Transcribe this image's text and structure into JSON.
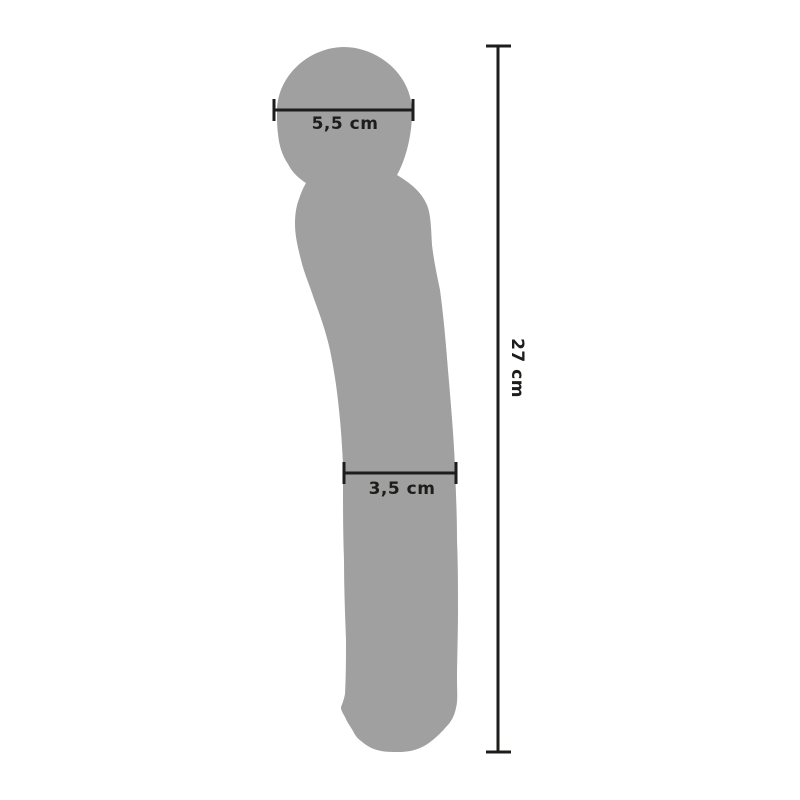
{
  "diagram": {
    "type": "product-dimension-drawing",
    "measurements": {
      "head_width": "5,5 cm",
      "shaft_width": "3,5 cm",
      "length": "27 cm"
    },
    "colors": {
      "silhouette": "#a0a0a0",
      "dimension": "#1d1d1b",
      "background": "#ffffff"
    }
  }
}
